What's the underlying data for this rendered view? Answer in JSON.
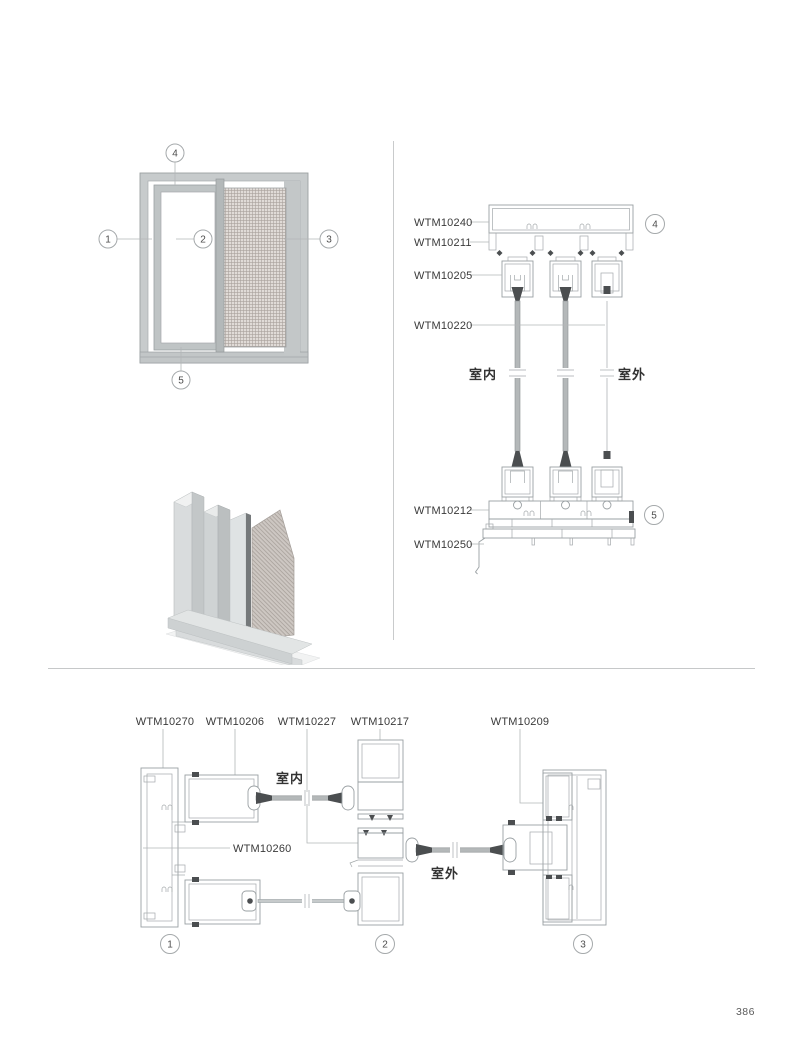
{
  "page": {
    "number": "386"
  },
  "elevation": {
    "callouts": [
      "1",
      "2",
      "3",
      "4",
      "5"
    ]
  },
  "vsec": {
    "labels": [
      "WTM10240",
      "WTM10211",
      "WTM10205",
      "WTM10220",
      "WTM10212",
      "WTM10250"
    ],
    "indoor": "室内",
    "outdoor": "室外",
    "callout_head": "4",
    "callout_sill": "5"
  },
  "hsec": {
    "labels": [
      "WTM10270",
      "WTM10206",
      "WTM10227",
      "WTM10217",
      "WTM10209"
    ],
    "label_frame": "WTM10260",
    "indoor": "室内",
    "outdoor": "室外",
    "callouts": [
      "1",
      "2",
      "3"
    ]
  },
  "colors": {
    "drawing_line": "#9aa0a3",
    "seal_dark": "#4b4e50",
    "label_text": "#3a3a3a",
    "frame_fill": "#c7cbcc",
    "mesh_fill": "#ded9d5",
    "divider": "#c8c8c8"
  }
}
